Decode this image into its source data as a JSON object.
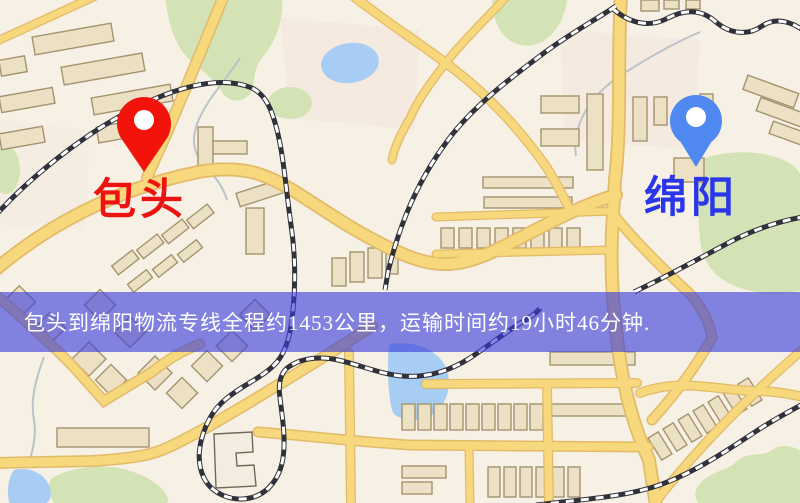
{
  "banner": {
    "text": "包头到绵阳物流专线全程约1453公里，运输时间约19小时46分钟.",
    "text_color": "#ffffff",
    "overlay_color": "rgba(56,60,220,0.62)"
  },
  "markers": {
    "origin": {
      "label": "包头",
      "pin_color": "#f2140a",
      "label_color": "#ee1310"
    },
    "destination": {
      "label": "绵阳",
      "pin_color": "#4f88f0",
      "label_color": "#2a36e9"
    }
  },
  "map_colors": {
    "background": "#f7f1e5",
    "road_fill": "#f7d87d",
    "road_casing": "#e2ba69",
    "railway": "#30313a",
    "park": "#d3e3b5",
    "water": "#a8cdf4",
    "building": "#ece1c5"
  }
}
